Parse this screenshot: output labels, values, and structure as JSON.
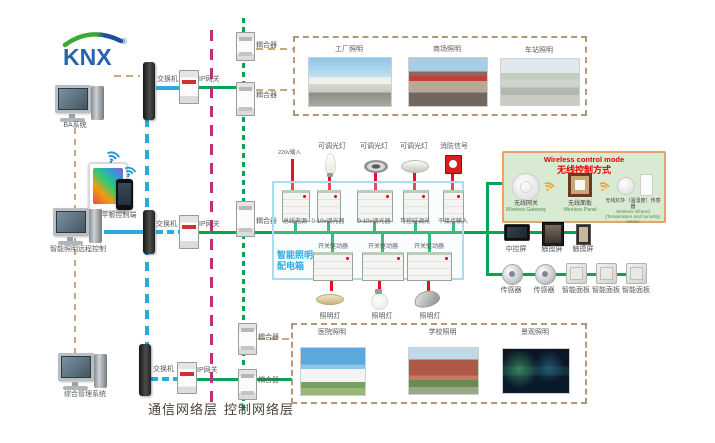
{
  "logo": {
    "text": "KNX",
    "registered": "®"
  },
  "left_column": {
    "computer1_label": "BA系统",
    "mobile_label": "手机平板控制端",
    "computer2_label": "智能照明远程控制",
    "computer3_label": "综合管理系统"
  },
  "network": {
    "switch_label": "交换机",
    "gateway_label": "IP网关",
    "coupler_label": "耦合器",
    "comm_layer_label": "通信网络层",
    "ctrl_layer_label": "控制网络层"
  },
  "top_gallery": {
    "photos": [
      {
        "label": "工厂照明"
      },
      {
        "label": "商场照明"
      },
      {
        "label": "车站照明"
      }
    ]
  },
  "bottom_gallery": {
    "photos": [
      {
        "label": "医院照明"
      },
      {
        "label": "学校照明"
      },
      {
        "label": "景观照明"
      }
    ]
  },
  "panel": {
    "title_line1": "智能照明",
    "title_line2": "配电箱",
    "power_input_label": "220v输入",
    "lights": [
      {
        "label": "可调光灯"
      },
      {
        "label": "可调光灯"
      },
      {
        "label": "可调光灯"
      },
      {
        "label": "消防信号"
      }
    ],
    "row1_devices": [
      {
        "label": "总线电源"
      },
      {
        "label": "0-10v调光器"
      },
      {
        "label": "0-10v调光器"
      },
      {
        "label": "可控硅调光"
      },
      {
        "label": "干接点输入"
      }
    ],
    "row2_devices": [
      {
        "label": "开关驱动器"
      },
      {
        "label": "开关驱动器"
      },
      {
        "label": "开关驱动器"
      }
    ],
    "lamps": [
      {
        "label": "照明灯"
      },
      {
        "label": "照明灯"
      },
      {
        "label": "照明灯"
      }
    ]
  },
  "wireless_box": {
    "title_en": "Wireless control mode",
    "title_zh": "无线控制方式",
    "items": [
      {
        "zh": "无线网关",
        "en": "Wireless Gateway"
      },
      {
        "zh": "无线面板",
        "en": "Wireless Panel"
      },
      {
        "zh": "无线红外（温湿度）传感器",
        "en": "Wireless infrared (Temperature and humidity) sensor"
      }
    ]
  },
  "right_devices": {
    "screens": [
      {
        "label": "中控屏"
      },
      {
        "label": "触摸屏"
      },
      {
        "label": "触摸屏"
      }
    ],
    "row2": [
      {
        "label": "传感器"
      },
      {
        "label": "传感器"
      },
      {
        "label": "智能面板"
      },
      {
        "label": "智能面板"
      },
      {
        "label": "智能面板"
      }
    ]
  },
  "colors": {
    "bus_green": "#00a651",
    "comm_blue": "#29abe2",
    "layer_divider_magenta": "#bf2f7b",
    "power_red": "#e81123",
    "dashed_tan": "#c9a87c",
    "panel_blue": "#29abe2",
    "wireless_bg": "#d9ead3",
    "wireless_border": "#eda06a",
    "wireless_title_red": "#e60000"
  }
}
